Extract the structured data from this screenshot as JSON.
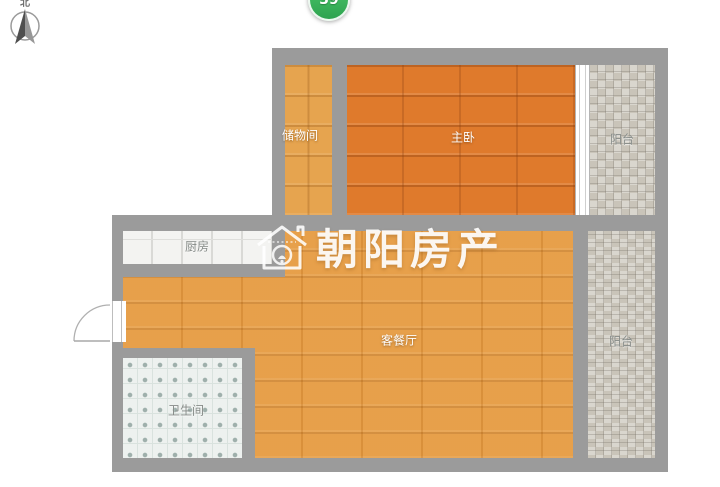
{
  "compass": {
    "label": "北"
  },
  "badge": {
    "value": "39",
    "color": "#3fbf61"
  },
  "watermark": {
    "text": "朝阳房产"
  },
  "rooms": [
    {
      "id": "storage",
      "label": "储物间"
    },
    {
      "id": "master-bedroom",
      "label": "主卧"
    },
    {
      "id": "balcony-top",
      "label": "阳台"
    },
    {
      "id": "kitchen",
      "label": "厨房"
    },
    {
      "id": "living-dining",
      "label": "客餐厅"
    },
    {
      "id": "bathroom",
      "label": "卫生间"
    },
    {
      "id": "balcony-bottom",
      "label": "阳台"
    }
  ],
  "colors": {
    "wall": "#9b9b9b",
    "bedroom_floor": "#df7a2c",
    "living_floor": "#e69b41",
    "storage_floor": "#e6a44f",
    "balcony_tile": "#c9c4b9",
    "kitchen_tile": "#f3f3f1",
    "bath_tile": "#edf1ef",
    "badge_green": "#3fbf61"
  }
}
